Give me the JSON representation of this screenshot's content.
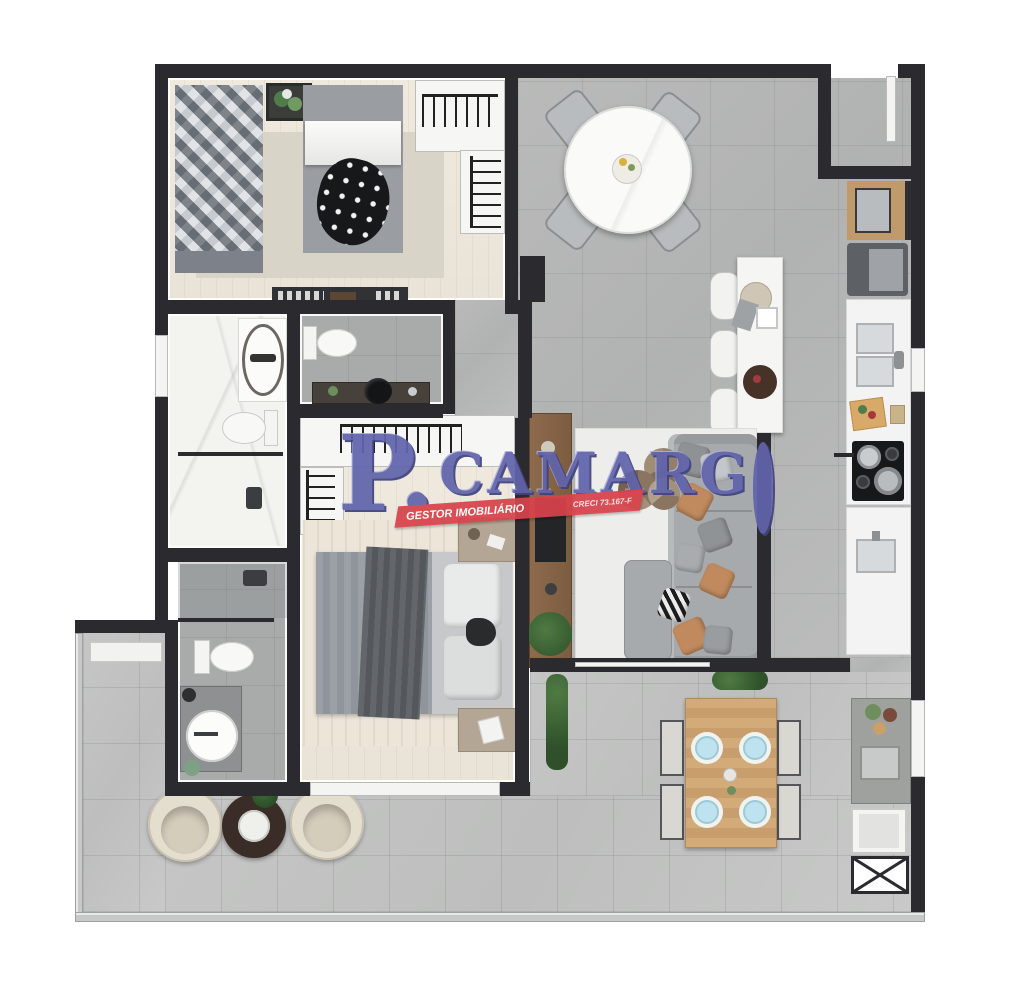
{
  "watermark": {
    "brand_p": "P.",
    "brand_rest": "CAMARG",
    "brand_o_shape": "ring-O",
    "tagline": "GESTOR IMOBILIÁRIO",
    "registration": "CRECI 73.167-F",
    "brand_color": "#6164ab",
    "banner_color": "#d8434b"
  },
  "plan": {
    "type": "apartment-floor-plan-top-view",
    "palette": {
      "walls": "#2b2b2f",
      "tile_gray": "#b5b6b6",
      "terrace_tile": "#c3c4c3",
      "bedroom_floor": "#ece7dc",
      "marble": "#f3f3f0",
      "wood_cabinet": "#c19a6b",
      "tv_panel_wood": "#8d6b4c",
      "sofa": "#a7aaac",
      "accent_pillow_tan": "#c08a5e",
      "armchair_cream": "#e4decf"
    },
    "rooms": [
      {
        "name": "bedroom-1",
        "furniture": [
          "single-bed-diamond-quilt",
          "double-bed-polkadot-throw",
          "plant-art-frame",
          "closet-hanger-racks",
          "tv-console",
          "area-rug"
        ]
      },
      {
        "name": "dining-room",
        "furniture": [
          "round-marble-table",
          "four-gray-chairs",
          "flower-centerpiece"
        ]
      },
      {
        "name": "kitchen",
        "furniture": [
          "breakfast-island",
          "three-stools",
          "serving-trays",
          "wood-cabinet",
          "refrigerator",
          "double-sink-counter",
          "cutting-board",
          "cooktop-with-pans",
          "second-sink-counter"
        ]
      },
      {
        "name": "entry",
        "furniture": [
          "entrance-door"
        ]
      },
      {
        "name": "bathroom-1",
        "furniture": [
          "freestanding-stone-tub",
          "toilet",
          "glass-shower"
        ]
      },
      {
        "name": "lavatory",
        "furniture": [
          "toilet",
          "dark-vanity-vessel-sink"
        ]
      },
      {
        "name": "master-suite",
        "furniture": [
          "walk-in-closet-racks",
          "double-bed-gray-bedding",
          "two-nightstands",
          "striped-rug"
        ]
      },
      {
        "name": "living-room",
        "furniture": [
          "l-shaped-sectional-sofa",
          "throw-pillows",
          "round-nesting-coffee-tables",
          "white-rug",
          "wood-tv-panel",
          "floor-plant"
        ]
      },
      {
        "name": "bathroom-2",
        "furniture": [
          "shower",
          "toilet",
          "round-basin-vanity"
        ]
      },
      {
        "name": "terrace",
        "furniture": [
          "white-bench",
          "two-cream-armchairs",
          "round-dark-coffee-table",
          "potted-plant"
        ]
      },
      {
        "name": "gourmet-terrace",
        "furniture": [
          "wood-dining-table",
          "four-chairs",
          "four-blue-place-settings",
          "counter-with-sink",
          "cabinet",
          "utility-shaft"
        ]
      }
    ]
  }
}
